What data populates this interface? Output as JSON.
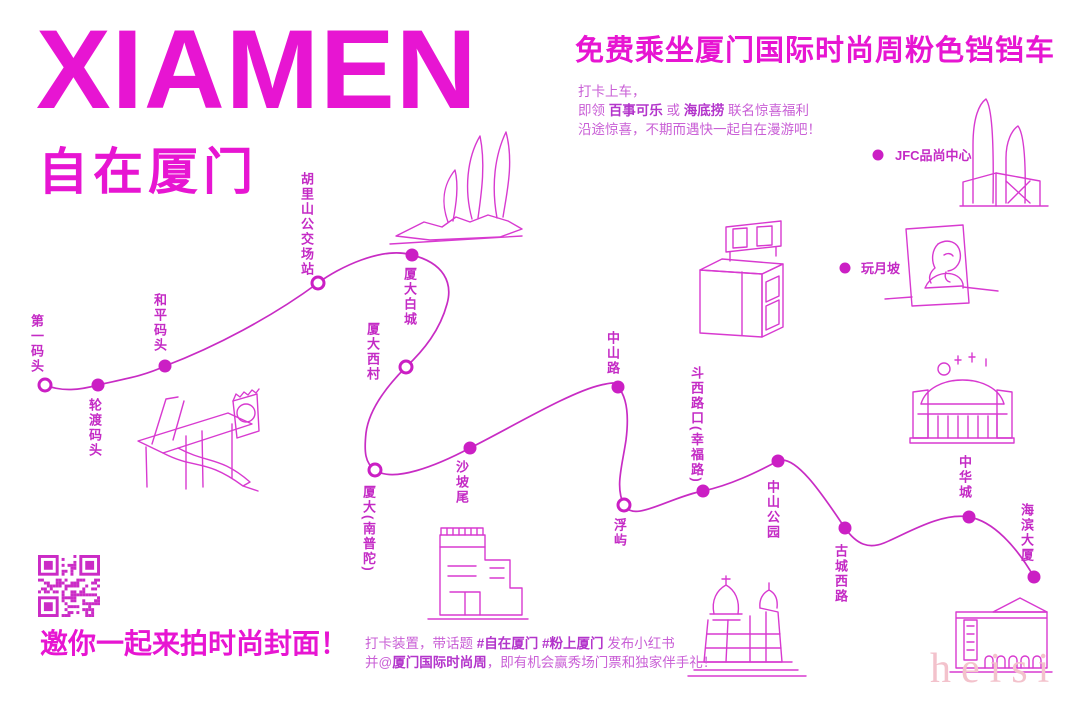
{
  "colors": {
    "magenta": "#E715D2",
    "route": "#C82CC4",
    "label": "#C42BC5",
    "copy": "#C95FD6",
    "buildings": "#D83AD0",
    "watermark_pink": "#F3C2CC"
  },
  "brand": {
    "title": "XIAMEN",
    "subtitle": "自在厦门"
  },
  "header": {
    "headline": "免费乘坐厦门国际时尚周粉色铛铛车",
    "copy1": "打卡上车，",
    "copy2a": "即领 ",
    "copy2b": "百事可乐",
    "copy2c": " 或 ",
    "copy2d": "海底捞",
    "copy2e": " 联名惊喜福利",
    "copy3": "沿途惊喜，不期而遇快一起自在漫游吧！"
  },
  "route": {
    "type": "tram-route",
    "stops": [
      {
        "name": "第一码头",
        "marker": "open"
      },
      {
        "name": "轮渡码头",
        "marker": "filled"
      },
      {
        "name": "和平码头",
        "marker": "filled"
      },
      {
        "name": "胡里山公交场站",
        "marker": "open"
      },
      {
        "name": "厦大白城",
        "marker": "filled"
      },
      {
        "name": "厦大西村",
        "marker": "open"
      },
      {
        "name": "厦大(南普陀)",
        "marker": "open"
      },
      {
        "name": "沙坡尾",
        "marker": "filled"
      },
      {
        "name": "中山路",
        "marker": "filled"
      },
      {
        "name": "浮屿",
        "marker": "open"
      },
      {
        "name": "斗西路口(幸福路)",
        "marker": "filled"
      },
      {
        "name": "中山公园",
        "marker": "filled"
      },
      {
        "name": "古城西路",
        "marker": "filled"
      },
      {
        "name": "中华城",
        "marker": "filled"
      },
      {
        "name": "海滨大厦",
        "marker": "filled"
      }
    ]
  },
  "landmarks": [
    {
      "name": "JFC品尚中心"
    },
    {
      "name": "玩月坡"
    }
  ],
  "footer": {
    "tagline": "邀你一起来拍时尚封面！",
    "note1a": "打卡装置，带话题 ",
    "note1b": "#自在厦门 #粉上厦门",
    "note1c": " 发布小红书",
    "note2a": "并@",
    "note2b": "厦门国际时尚周",
    "note2c": "，即有机会赢秀场门票和独家伴手礼！"
  },
  "watermark": "heisi"
}
